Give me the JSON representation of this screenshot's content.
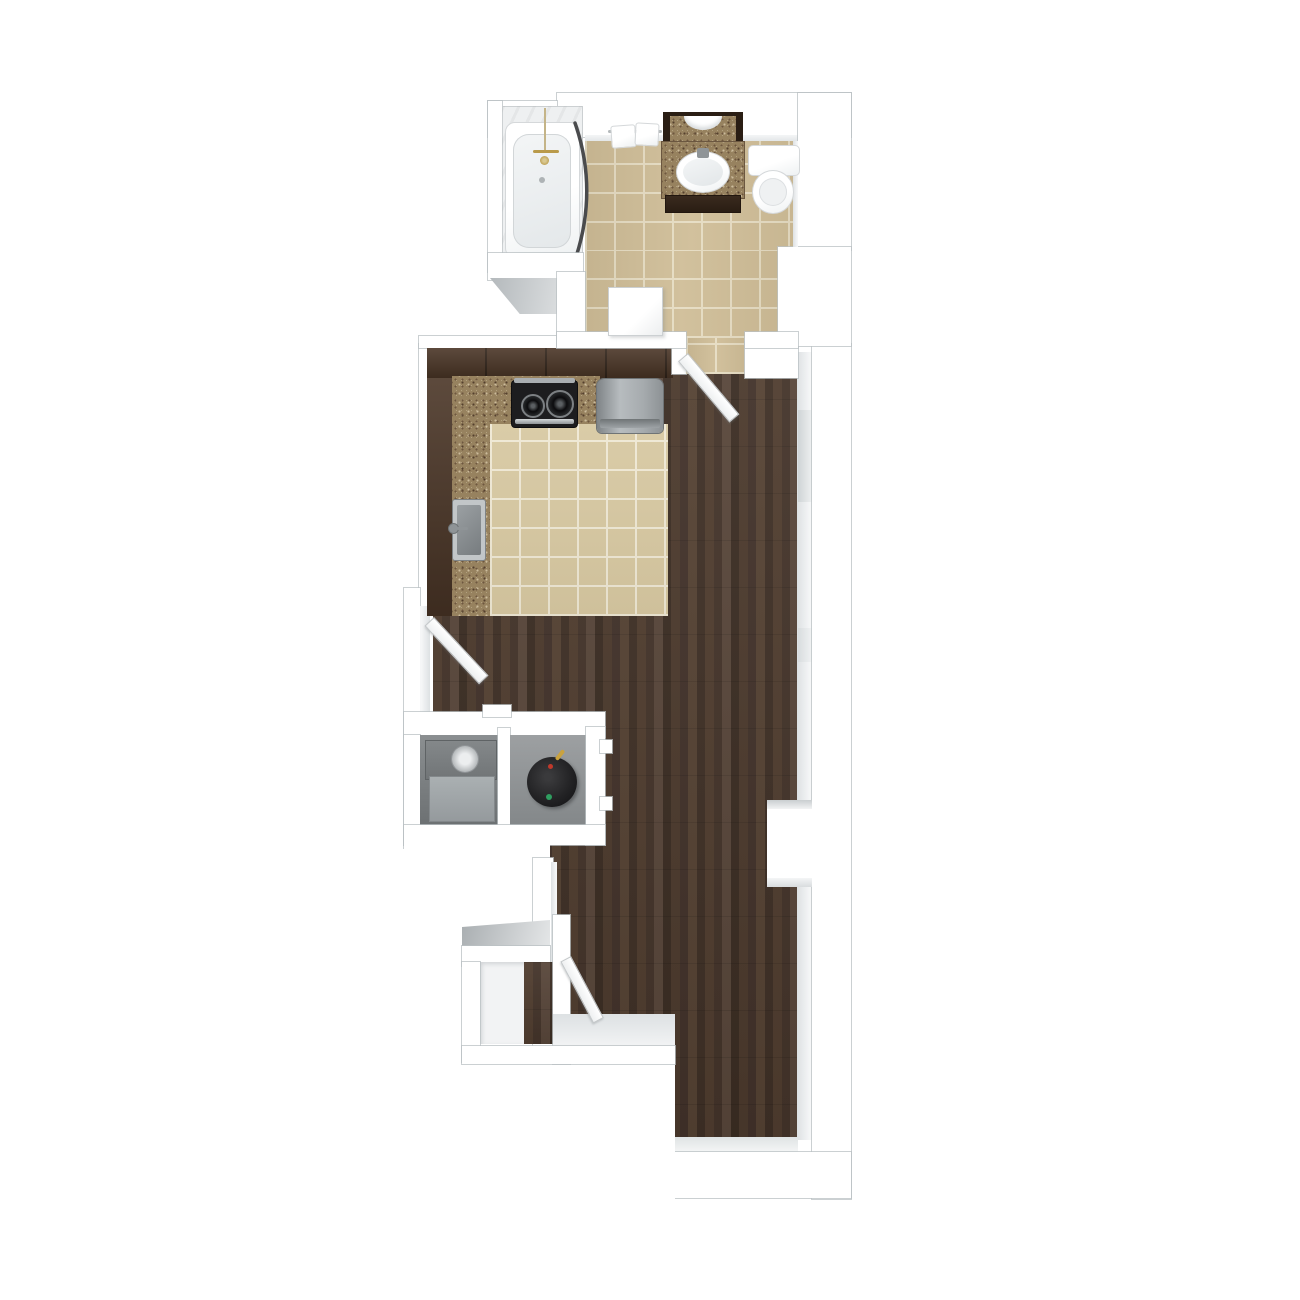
{
  "image": {
    "kind": "apartment-floor-plan-3d-top-view",
    "description": "3D top-down rendered floor plan of a narrow studio apartment: bathroom at top, galley kitchen with tile floor, long hardwood living area, two utility closets, entry with closet at bottom left",
    "background": "#ffffff"
  },
  "palette": {
    "wall": "#ffffff",
    "wallLine": "#c3c8ca",
    "wallFace": "#e2e5e7",
    "wood": "#473629",
    "bathTile": "#cfbd97",
    "kitchenTile": "#d7c8a1",
    "grout": "#e8dfc8",
    "cabinet": "#4a3526",
    "granite": "#97825f",
    "vanityBase": "#31231a",
    "mirrorFrame": "#2a1e14",
    "stove": "#1d1d1f",
    "stoveBurner": "#0c0c0e",
    "stainless": "#b7bcbe",
    "fridge": "#9aa0a3",
    "fridgeBand": "#6f7476",
    "sinkSteel": "#8a8f92",
    "sinkRim": "#c2c6c8",
    "hvacTop": "#7b7f81",
    "hvacFront": "#a1a6a9",
    "knob": "#d3d7d9",
    "waterHeater": "#232325",
    "heaterRed": "#c0392b",
    "heaterGreen": "#2f9e60",
    "heaterPipe": "#c9a23f",
    "brass": "#b99a4a",
    "curtainRod": "#4a4b4d",
    "doorWhite": "#fafbfb",
    "closetFloorWhite": "#f2f3f4"
  },
  "rooms": [
    {
      "id": "bathroom",
      "label": "Bathroom",
      "floor_material": "beige ceramic tile"
    },
    {
      "id": "kitchen",
      "label": "Kitchen",
      "floor_material": "beige ceramic tile"
    },
    {
      "id": "living-area",
      "label": "Living / Sleeping Area",
      "floor_material": "dark hardwood plank"
    },
    {
      "id": "utility-closet-hvac",
      "label": "Utility Closet (HVAC)",
      "floor_material": "concrete"
    },
    {
      "id": "utility-closet-water-heater",
      "label": "Utility Closet (Water Heater)",
      "floor_material": "concrete"
    },
    {
      "id": "entry-closet",
      "label": "Entry Closet",
      "floor_material": "white / hardwood"
    },
    {
      "id": "entry",
      "label": "Entry Hall",
      "floor_material": "dark hardwood plank"
    }
  ],
  "fixtures": [
    {
      "id": "bathtub",
      "room": "bathroom",
      "type": "alcove tub with brass shower fixture and curved curtain rod"
    },
    {
      "id": "towel-bar",
      "room": "bathroom",
      "type": "towel bar with two towels"
    },
    {
      "id": "vanity",
      "room": "bathroom",
      "type": "granite-top vanity with oval sink, mirror above, dark wood base"
    },
    {
      "id": "toilet",
      "room": "bathroom",
      "type": "two-piece toilet"
    },
    {
      "id": "range",
      "room": "kitchen",
      "type": "black cooktop range with stainless handle"
    },
    {
      "id": "refrigerator",
      "room": "kitchen",
      "type": "stainless refrigerator"
    },
    {
      "id": "kitchen-sink",
      "room": "kitchen",
      "type": "stainless single-bowl sink with faucet"
    },
    {
      "id": "cabinets",
      "room": "kitchen",
      "type": "L-shaped dark wood cabinets with granite countertop"
    },
    {
      "id": "hvac-unit",
      "room": "utility-closet-hvac",
      "type": "gray HVAC / furnace unit"
    },
    {
      "id": "water-heater",
      "room": "utility-closet-water-heater",
      "type": "round black water heater, red and green indicators"
    }
  ],
  "doors": [
    {
      "id": "bathroom-door-flat",
      "state": "open flat on bathroom floor"
    },
    {
      "id": "bathroom-doorway-door",
      "state": "open ~50 deg, swings from living area into hallway below bathroom"
    },
    {
      "id": "kitchen-side-door",
      "state": "open ~45 deg, hinged on left wall below kitchen"
    },
    {
      "id": "entry-door",
      "state": "open ~60 deg, hinged beside entry closet"
    }
  ]
}
